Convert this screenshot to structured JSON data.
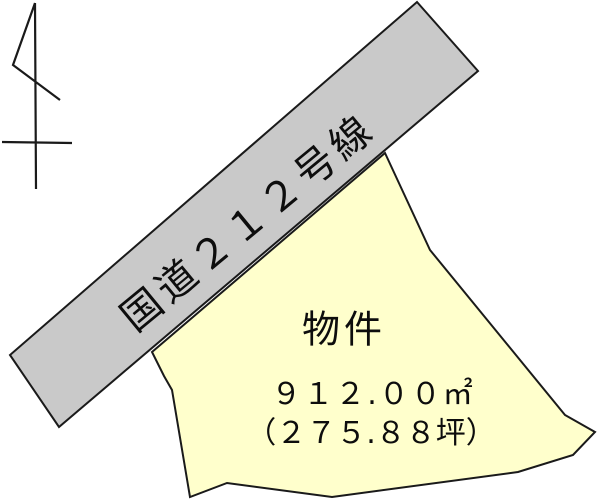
{
  "road": {
    "label": "国道２１２号線",
    "fill_color": "#c9c9c9",
    "outline_color": "#1a1a1a"
  },
  "parcel": {
    "label": "物件",
    "area_m2": "９１２.００㎡",
    "area_tsubo": "（２７５.８８坪）",
    "fill_color": "#ffffcc",
    "outline_color": "#1a1a1a"
  },
  "north_arrow": {
    "icon": "north-arrow"
  }
}
